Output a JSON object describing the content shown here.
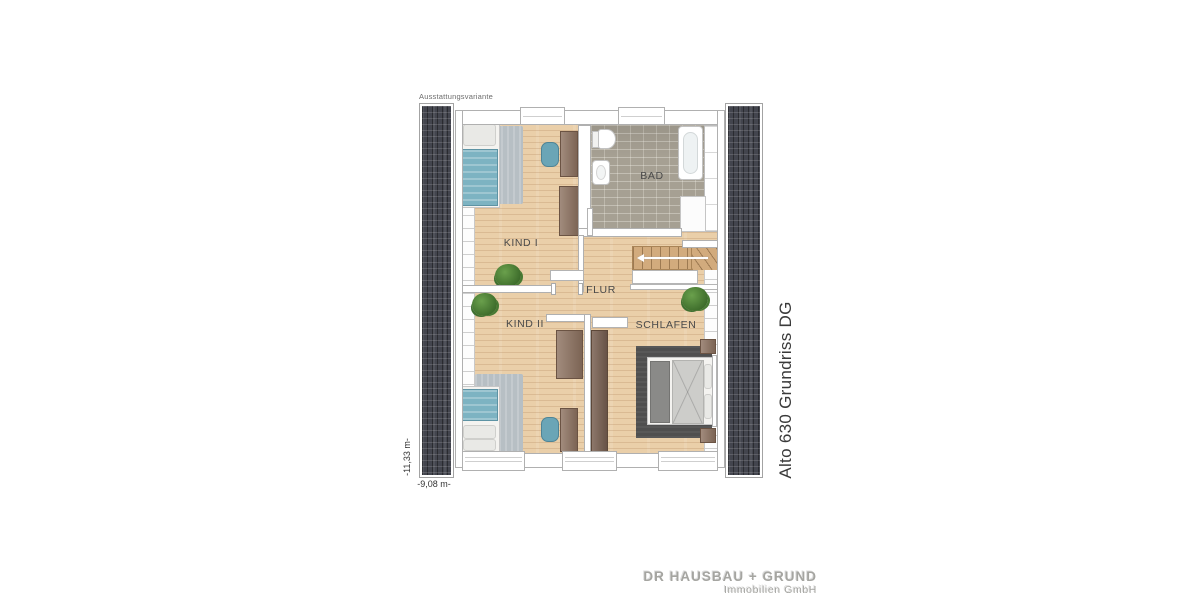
{
  "plan": {
    "note": "Ausstattungsvariante",
    "title": "Alto 630 Grundriss DG",
    "dim_vertical": "-11,33 m-",
    "dim_horizontal": "-9,08 m-",
    "rooms": {
      "kind1": "KIND I",
      "bad": "BAD",
      "flur": "FLUR",
      "kind2": "KIND II",
      "schlafen": "SCHLAFEN"
    },
    "colors": {
      "floor_wood": "#eacfa9",
      "floor_tile": "#a6a093",
      "roof": "#43454e",
      "wall": "#ffffff",
      "furniture_brown": "#8d7260",
      "accent_teal": "#6aa5b6",
      "rug_gray": "#b7bfc4",
      "rug_dark": "#4f4f4f",
      "plant_green": "#4f8436"
    }
  },
  "branding": {
    "line1": "DR HAUSBAU + GRUND",
    "line2": "Immobilien GmbH"
  }
}
